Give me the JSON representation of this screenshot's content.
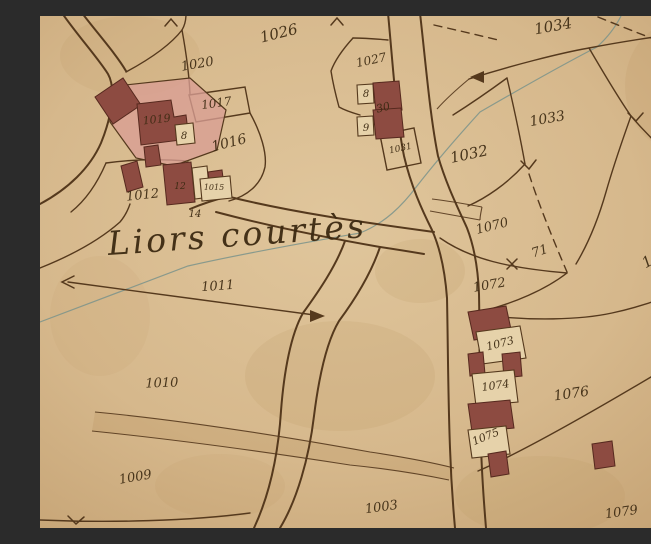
{
  "map": {
    "kind": "historical cadastral map sheet",
    "toponym": "Liors courtès",
    "palette": {
      "paper": "#d6b88c",
      "paper-light": "#e6d2aa",
      "line": "#55391d",
      "ink": "#3c2a12",
      "building": "#8d4b41",
      "building-stroke": "#56291e",
      "courtyard": "#d89d93",
      "survey": "#7a938b",
      "stain": "#a57d44"
    },
    "labels": [
      {
        "id": "p1026",
        "text": "1026",
        "x": 240,
        "y": 22,
        "rot": -14,
        "size": 15,
        "kind": "parcel"
      },
      {
        "id": "p1020",
        "text": "1020",
        "x": 158,
        "y": 52,
        "rot": -10,
        "size": 13,
        "kind": "parcel"
      },
      {
        "id": "p1017",
        "text": "1017",
        "x": 177,
        "y": 91,
        "rot": -8,
        "size": 12,
        "kind": "parcel"
      },
      {
        "id": "p1019",
        "text": "1019",
        "x": 117,
        "y": 107,
        "rot": -6,
        "size": 11,
        "kind": "parcel"
      },
      {
        "id": "b8a",
        "text": "8",
        "x": 144,
        "y": 123,
        "rot": 0,
        "size": 10,
        "kind": "building"
      },
      {
        "id": "p1016",
        "text": "1016",
        "x": 190,
        "y": 131,
        "rot": -14,
        "size": 14,
        "kind": "parcel"
      },
      {
        "id": "p1012",
        "text": "1012",
        "x": 103,
        "y": 183,
        "rot": -6,
        "size": 13,
        "kind": "parcel"
      },
      {
        "id": "b12",
        "text": "12",
        "x": 140,
        "y": 173,
        "rot": 0,
        "size": 9,
        "kind": "building"
      },
      {
        "id": "b1015",
        "text": "1015",
        "x": 174,
        "y": 174,
        "rot": 0,
        "size": 8,
        "kind": "building"
      },
      {
        "id": "b14",
        "text": "14",
        "x": 155,
        "y": 201,
        "rot": 0,
        "size": 10,
        "kind": "building"
      },
      {
        "id": "p1027",
        "text": "1027",
        "x": 332,
        "y": 48,
        "rot": -12,
        "size": 12,
        "kind": "parcel"
      },
      {
        "id": "b8b",
        "text": "8",
        "x": 326,
        "y": 81,
        "rot": 0,
        "size": 10,
        "kind": "building"
      },
      {
        "id": "b30",
        "text": "30",
        "x": 344,
        "y": 95,
        "rot": -15,
        "size": 11,
        "kind": "building"
      },
      {
        "id": "b9",
        "text": "9",
        "x": 326,
        "y": 115,
        "rot": 0,
        "size": 10,
        "kind": "building"
      },
      {
        "id": "p1031",
        "text": "1031",
        "x": 361,
        "y": 135,
        "rot": -12,
        "size": 9,
        "kind": "building"
      },
      {
        "id": "p1032",
        "text": "1032",
        "x": 430,
        "y": 143,
        "rot": -12,
        "size": 15,
        "kind": "parcel"
      },
      {
        "id": "p1033",
        "text": "1033",
        "x": 508,
        "y": 107,
        "rot": -10,
        "size": 14,
        "kind": "parcel"
      },
      {
        "id": "p1034",
        "text": "1034",
        "x": 514,
        "y": 15,
        "rot": -10,
        "size": 15,
        "kind": "parcel"
      },
      {
        "id": "p106",
        "text": "106",
        "x": 634,
        "y": 99,
        "rot": -30,
        "size": 14,
        "kind": "parcel"
      },
      {
        "id": "p1070",
        "text": "1070",
        "x": 453,
        "y": 214,
        "rot": -14,
        "size": 13,
        "kind": "parcel"
      },
      {
        "id": "p71",
        "text": "71",
        "x": 501,
        "y": 239,
        "rot": -18,
        "size": 13,
        "kind": "parcel"
      },
      {
        "id": "p1069",
        "text": "1069",
        "x": 622,
        "y": 243,
        "rot": -30,
        "size": 15,
        "kind": "parcel"
      },
      {
        "id": "p1072",
        "text": "1072",
        "x": 450,
        "y": 273,
        "rot": -10,
        "size": 13,
        "kind": "parcel"
      },
      {
        "id": "p1011",
        "text": "1011",
        "x": 178,
        "y": 274,
        "rot": -4,
        "size": 13,
        "kind": "parcel"
      },
      {
        "id": "p1010",
        "text": "1010",
        "x": 122,
        "y": 371,
        "rot": -2,
        "size": 13,
        "kind": "parcel"
      },
      {
        "id": "p1073",
        "text": "1073",
        "x": 461,
        "y": 331,
        "rot": -14,
        "size": 11,
        "kind": "building"
      },
      {
        "id": "p1074",
        "text": "1074",
        "x": 456,
        "y": 373,
        "rot": -8,
        "size": 11,
        "kind": "building"
      },
      {
        "id": "p1076",
        "text": "1076",
        "x": 532,
        "y": 382,
        "rot": -8,
        "size": 14,
        "kind": "parcel"
      },
      {
        "id": "p1075",
        "text": "1075",
        "x": 447,
        "y": 424,
        "rot": -22,
        "size": 11,
        "kind": "building"
      },
      {
        "id": "p1009",
        "text": "1009",
        "x": 96,
        "y": 465,
        "rot": -10,
        "size": 13,
        "kind": "parcel"
      },
      {
        "id": "p1003",
        "text": "1003",
        "x": 342,
        "y": 495,
        "rot": -8,
        "size": 13,
        "kind": "parcel"
      },
      {
        "id": "p1079",
        "text": "1079",
        "x": 582,
        "y": 500,
        "rot": -8,
        "size": 13,
        "kind": "parcel"
      },
      {
        "id": "toponym",
        "text": "Liors courtès",
        "x": 198,
        "y": 230,
        "rot": -4,
        "size": 33,
        "kind": "place"
      }
    ]
  }
}
